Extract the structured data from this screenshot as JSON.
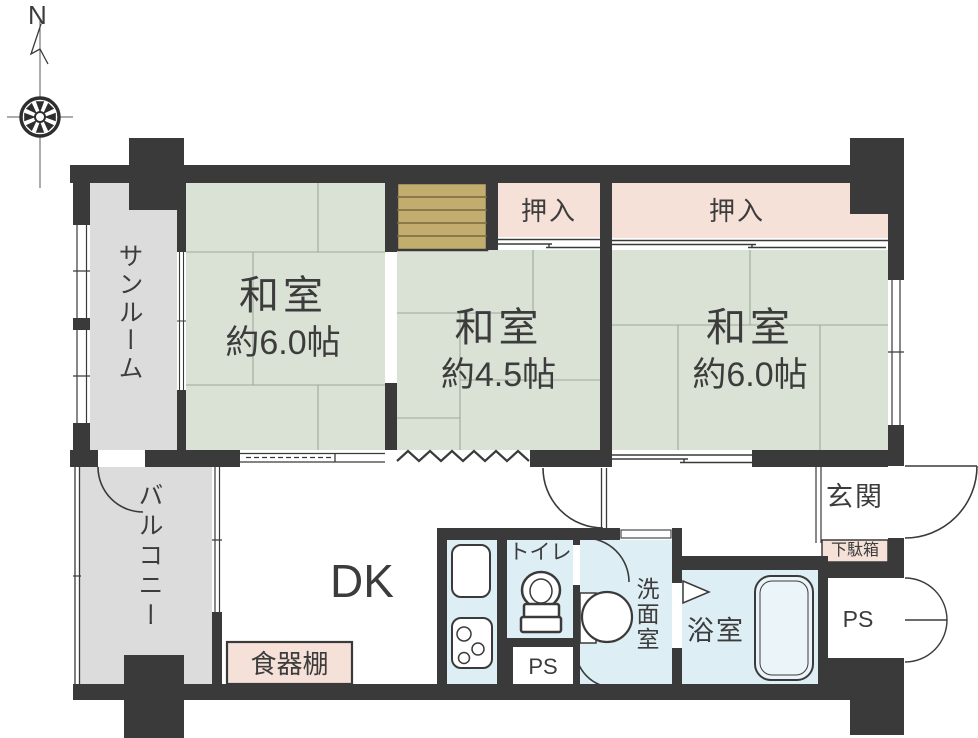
{
  "palette": {
    "wall": "#3a3a3a",
    "tatami_green": "#d9e2d5",
    "tatami_line": "#9fa89b",
    "closet_pink": "#f6e1d8",
    "gray_area": "#dcdcdc",
    "wet_blue": "#deeef5",
    "wood_tan": "#c3ad6e",
    "wood_line": "#796a3d",
    "text": "#3c3c3c"
  },
  "compass": {
    "north_label": "N"
  },
  "rooms": {
    "sunroom": {
      "label": "サンルーム"
    },
    "washitsu_left": {
      "label": "和室",
      "size": "約6.0帖"
    },
    "washitsu_center": {
      "label": "和室",
      "size": "約4.5帖"
    },
    "washitsu_right": {
      "label": "和室",
      "size": "約6.0帖"
    },
    "closet_center": {
      "label": "押入"
    },
    "closet_right": {
      "label": "押入"
    },
    "balcony": {
      "label": "バルコニー"
    },
    "dining_kitchen": {
      "label": "DK"
    },
    "cupboard": {
      "label": "食器棚"
    },
    "toilet": {
      "label": "トイレ"
    },
    "pipe_space_kitchen": {
      "label": "PS"
    },
    "washroom": {
      "label": "洗面室"
    },
    "bathroom": {
      "label": "浴室"
    },
    "entrance": {
      "label": "玄関"
    },
    "shoe_cabinet": {
      "label": "下駄箱"
    },
    "pipe_space_entrance": {
      "label": "PS"
    }
  }
}
